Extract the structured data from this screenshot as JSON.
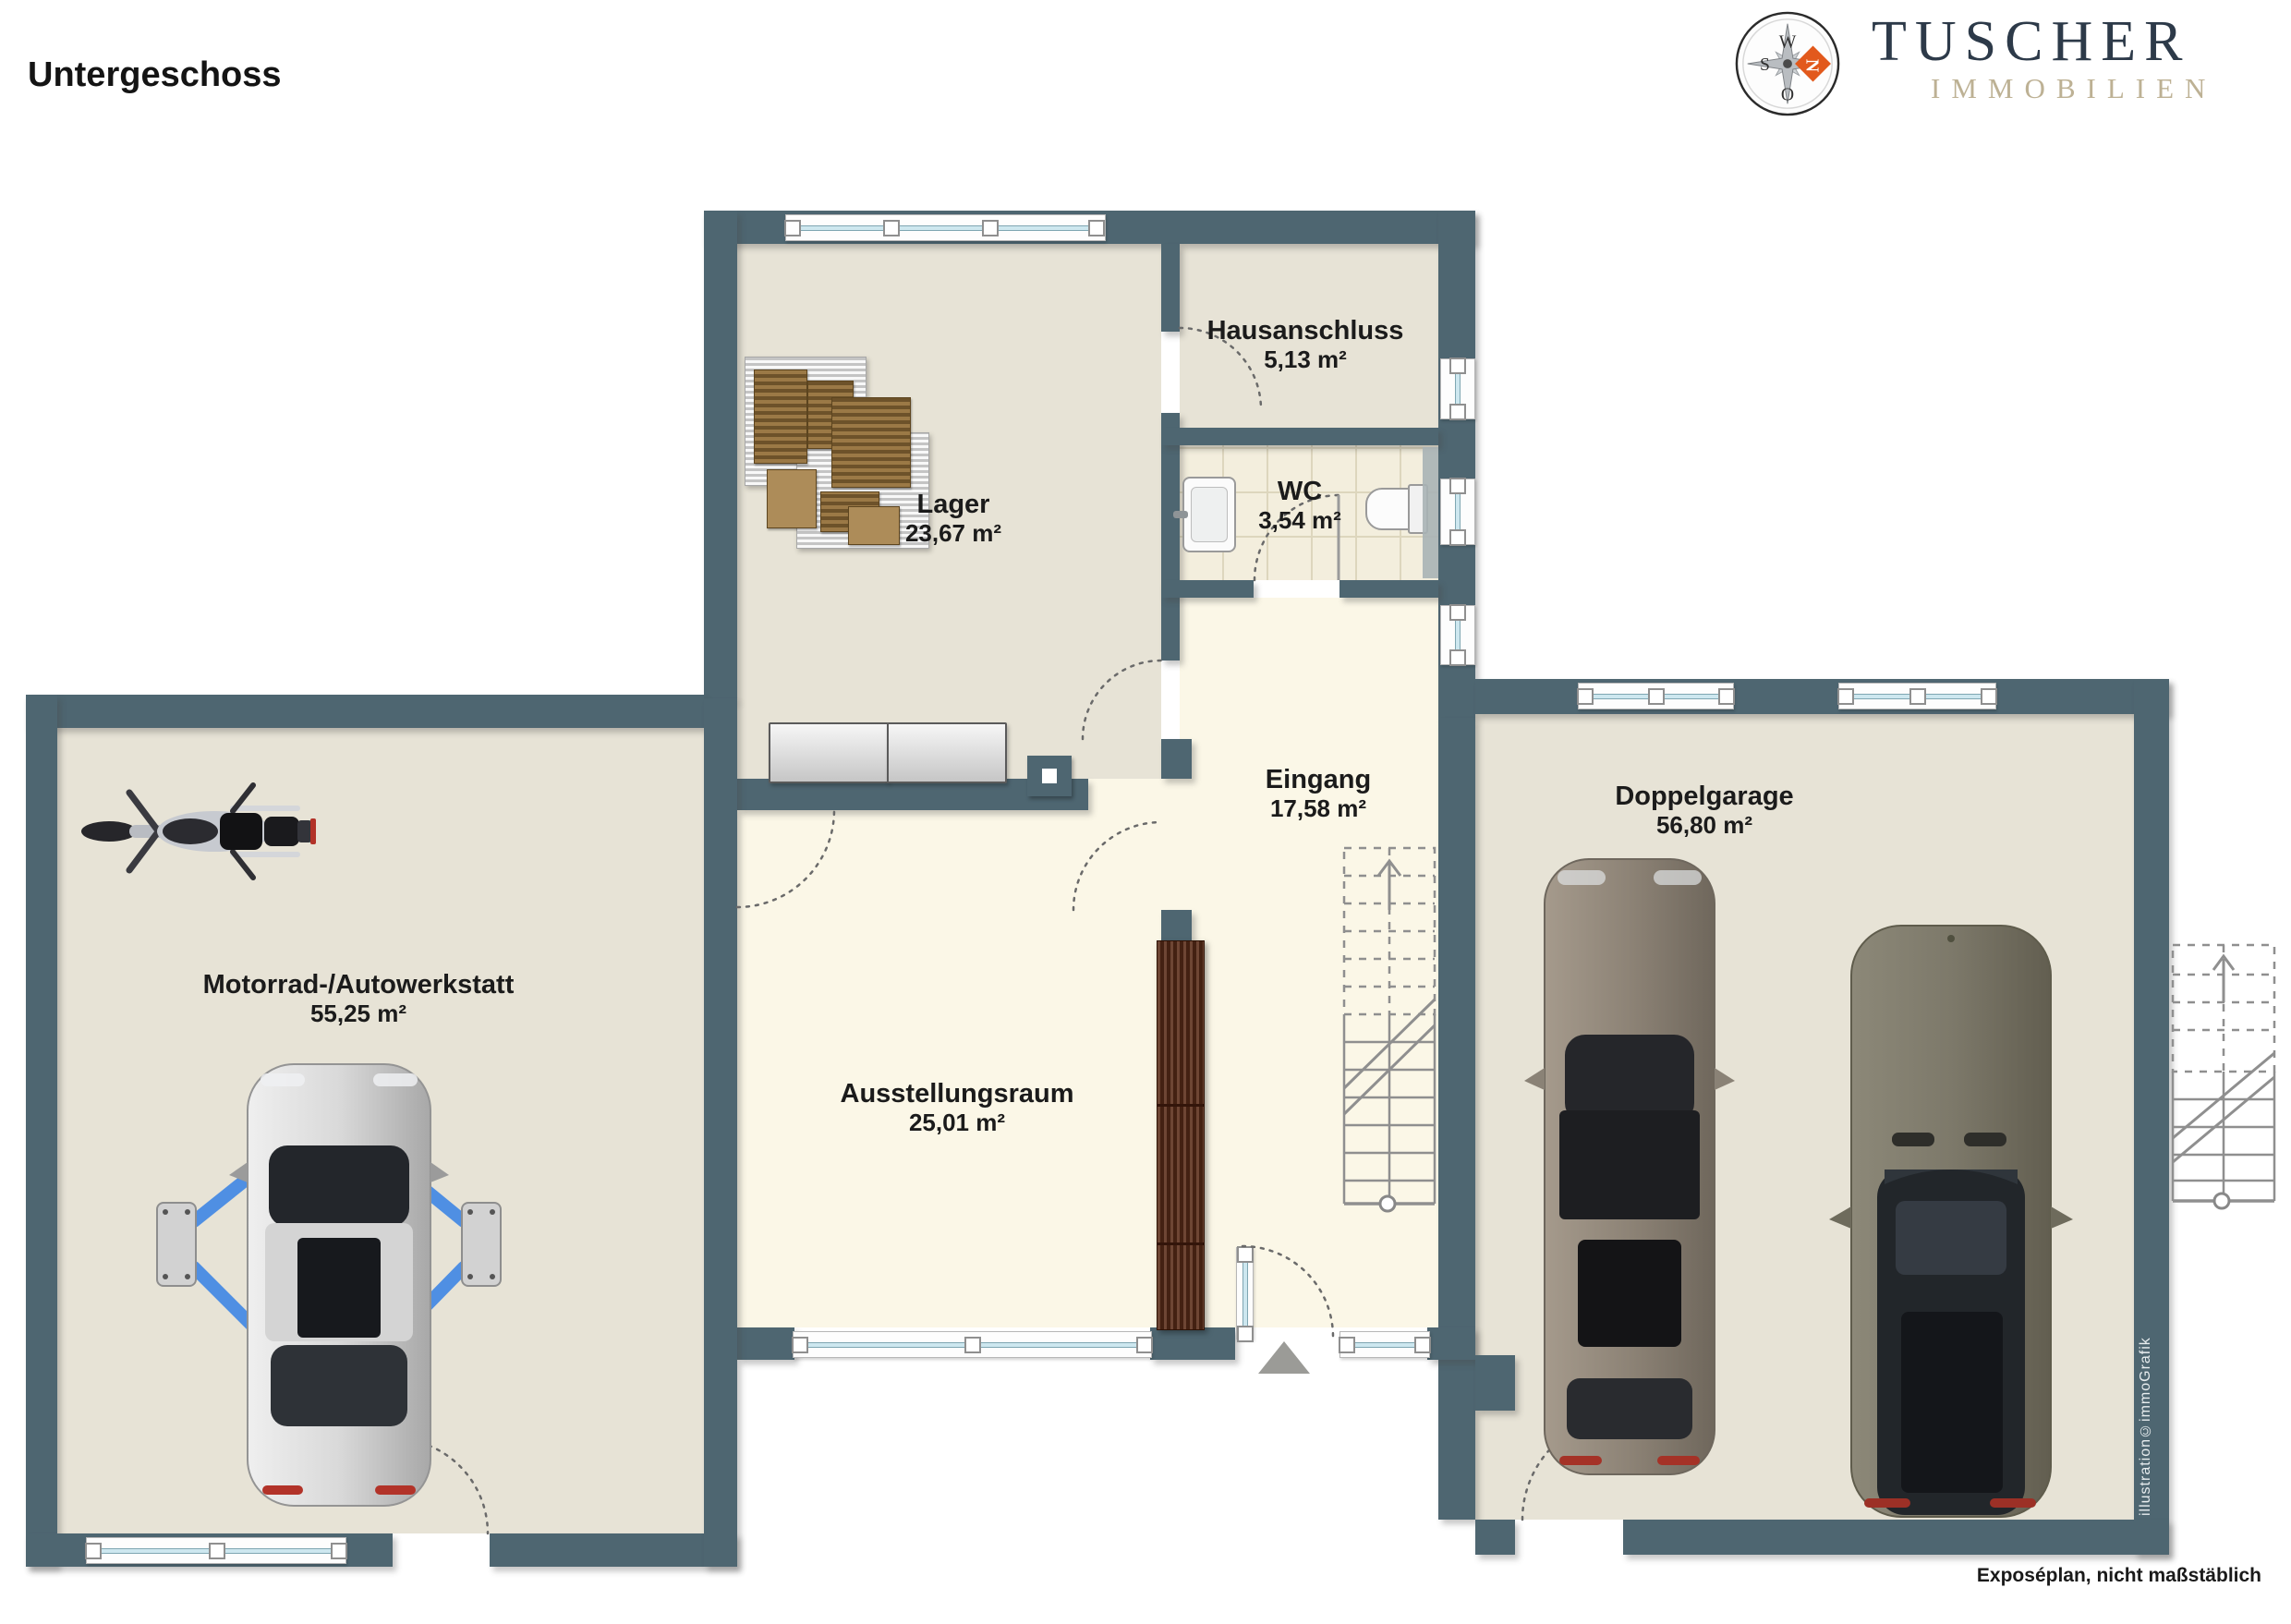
{
  "header": {
    "title": "Untergeschoss"
  },
  "brand": {
    "name": "TUSCHER",
    "subtitle": "IMMOBILIEN",
    "accent_orange": "#e2591c",
    "navy": "#2d3a49",
    "beige": "#bdb194",
    "compass": {
      "north": "N",
      "east": "O",
      "south": "S",
      "west": "W"
    }
  },
  "rooms": {
    "werkstatt": {
      "name": "Motorrad-/Autowerkstatt",
      "area": "55,25 m²"
    },
    "lager": {
      "name": "Lager",
      "area": "23,67 m²"
    },
    "hausanschluss": {
      "name": "Hausanschluss",
      "area": "5,13 m²"
    },
    "wc": {
      "name": "WC",
      "area": "3,54 m²"
    },
    "eingang": {
      "name": "Eingang",
      "area": "17,58 m²"
    },
    "ausstellungsraum": {
      "name": "Ausstellungsraum",
      "area": "25,01 m²"
    },
    "doppelgarage": {
      "name": "Doppelgarage",
      "area": "56,80 m²"
    }
  },
  "footer": {
    "disclaimer": "Exposéplan, nicht maßstäblich",
    "credit": "illustration©immoGrafik"
  },
  "colors": {
    "wall": "#4e6671",
    "floor_beige": "#e7e3d6",
    "floor_cream": "#fbf7e7",
    "floor_tile": "#f3eedd",
    "window_glass": "#cde7ef",
    "lift_blue": "#4f8fe3",
    "cabinet_brown": "#5a2c18"
  }
}
